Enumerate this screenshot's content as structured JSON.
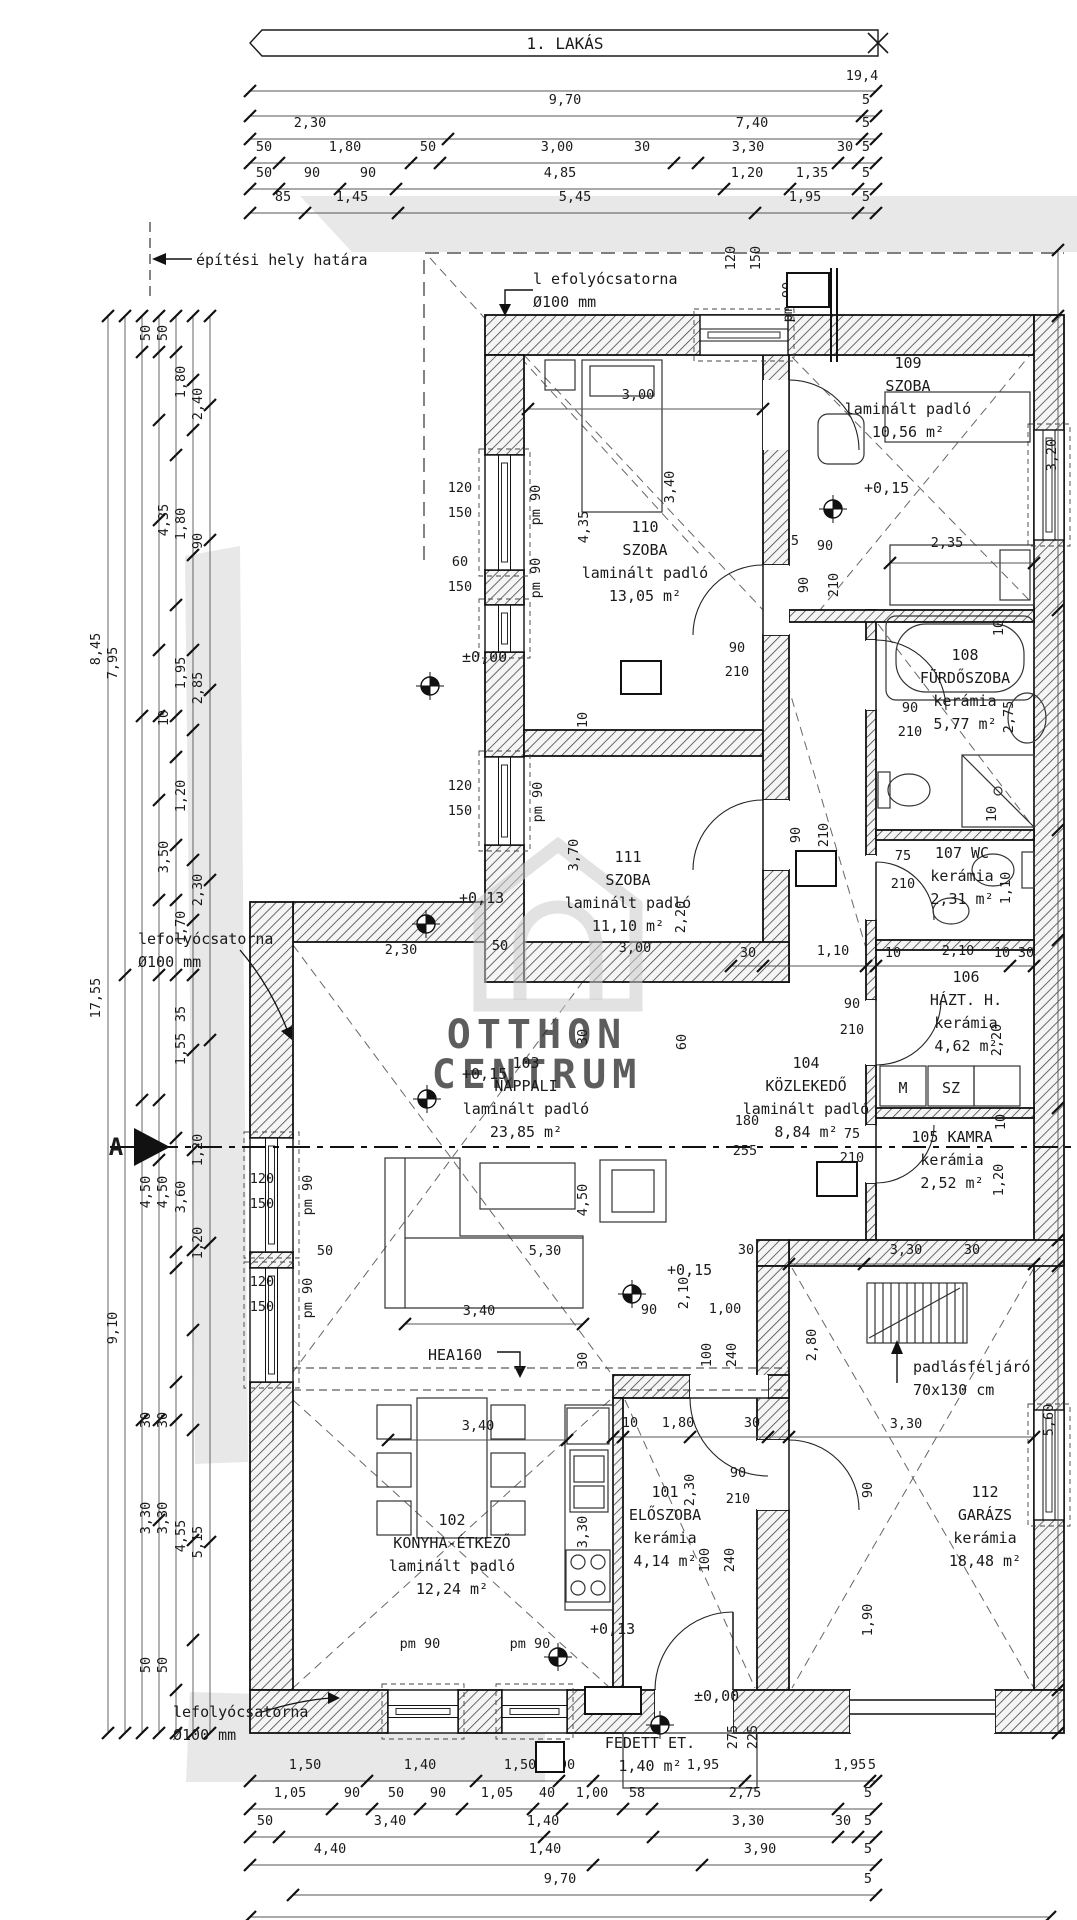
{
  "title": {
    "banner": "1. LAKÁS"
  },
  "watermark": {
    "line1": "OTTHON",
    "line2": "CENTRUM"
  },
  "section_marker": {
    "label": "A"
  },
  "colors": {
    "paper": "#ffffff",
    "site_band": "#e8e8e8",
    "ink": "#1a1a1a",
    "watermark_grey": "#c6c6c6"
  },
  "rooms": [
    {
      "id": "110",
      "lines": [
        "110",
        "SZOBA",
        "laminált padló",
        "13,05 m²"
      ],
      "x": 645,
      "y": 532
    },
    {
      "id": "109",
      "lines": [
        "109",
        "SZOBA",
        "laminált padló",
        "10,56 m²"
      ],
      "x": 908,
      "y": 368
    },
    {
      "id": "108",
      "lines": [
        "108",
        "FÜRDŐSZOBA",
        "kerámia",
        "5,77 m²"
      ],
      "x": 965,
      "y": 660
    },
    {
      "id": "107",
      "lines": [
        "107 WC",
        "kerámia",
        "2,31 m²"
      ],
      "x": 962,
      "y": 858
    },
    {
      "id": "106",
      "lines": [
        "106",
        "HÁZT. H.",
        "kerámia",
        "4,62 m²"
      ],
      "x": 966,
      "y": 982
    },
    {
      "id": "105",
      "lines": [
        "105 KAMRA",
        "kerámia",
        "2,52 m²"
      ],
      "x": 952,
      "y": 1142
    },
    {
      "id": "104",
      "lines": [
        "104",
        "KÖZLEKEDŐ",
        "laminált padló",
        "8,84 m²"
      ],
      "x": 806,
      "y": 1068
    },
    {
      "id": "103",
      "lines": [
        "103",
        "NAPPALI",
        "laminált padló",
        "23,85 m²"
      ],
      "x": 526,
      "y": 1068
    },
    {
      "id": "111",
      "lines": [
        "111",
        "SZOBA",
        "laminált padló",
        "11,10 m²"
      ],
      "x": 628,
      "y": 862
    },
    {
      "id": "102",
      "lines": [
        "102",
        "KONYHA-ÉTKEZŐ",
        "laminált padló",
        "12,24 m²"
      ],
      "x": 452,
      "y": 1525
    },
    {
      "id": "101",
      "lines": [
        "101",
        "ELŐSZOBA",
        "kerámia",
        "4,14 m²"
      ],
      "x": 665,
      "y": 1497
    },
    {
      "id": "112",
      "lines": [
        "112",
        "GARÁZS",
        "kerámia",
        "18,48 m²"
      ],
      "x": 985,
      "y": 1497
    },
    {
      "id": "K101",
      "lines": [
        "FEDETT ET.",
        "1,40 m²"
      ],
      "x": 650,
      "y": 1748
    }
  ],
  "ref_boxes": [
    {
      "t": "H01",
      "x": 787,
      "y": 273,
      "w": 42,
      "h": 34
    },
    {
      "t": "F04",
      "x": 621,
      "y": 661,
      "w": 40,
      "h": 33
    },
    {
      "t": "F01",
      "x": 796,
      "y": 851,
      "w": 40,
      "h": 35
    },
    {
      "t": "F02",
      "x": 817,
      "y": 1162,
      "w": 40,
      "h": 34
    },
    {
      "t": "K101",
      "x": 585,
      "y": 1687,
      "w": 56,
      "h": 27
    },
    {
      "t": "1",
      "x": 536,
      "y": 1742,
      "w": 28,
      "h": 30
    }
  ],
  "level_markers": [
    {
      "t": "±0,00",
      "tx": 458,
      "ty": 662,
      "mx": 430,
      "my": 686
    },
    {
      "t": "+0,13",
      "tx": 455,
      "ty": 903,
      "mx": 426,
      "my": 924
    },
    {
      "t": "+0,15",
      "tx": 860,
      "ty": 493,
      "mx": 833,
      "my": 509
    },
    {
      "t": "+0,15",
      "tx": 458,
      "ty": 1079,
      "mx": 427,
      "my": 1099
    },
    {
      "t": "+0,15",
      "tx": 663,
      "ty": 1275,
      "mx": 632,
      "my": 1294
    },
    {
      "t": "+0,13",
      "tx": 586,
      "ty": 1634,
      "mx": 558,
      "my": 1657
    },
    {
      "t": "±0,00",
      "tx": 690,
      "ty": 1701,
      "mx": 660,
      "my": 1725
    }
  ],
  "notes": [
    {
      "t": "l efolyócsatorna",
      "x": 533,
      "y": 284
    },
    {
      "t": "Ø100 mm",
      "x": 533,
      "y": 307
    },
    {
      "t": "építési hely határa",
      "x": 196,
      "y": 265
    },
    {
      "t": "lefolyócsatorna",
      "x": 138,
      "y": 944
    },
    {
      "t": "Ø100 mm",
      "x": 138,
      "y": 967
    },
    {
      "t": "lefolyócsatorna",
      "x": 173,
      "y": 1717
    },
    {
      "t": "Ø100 mm",
      "x": 173,
      "y": 1740
    },
    {
      "t": "padlásfeljáró",
      "x": 913,
      "y": 1372
    },
    {
      "t": "70x130 cm",
      "x": 913,
      "y": 1395
    },
    {
      "t": "HEA160",
      "x": 428,
      "y": 1360
    }
  ],
  "appliances": [
    {
      "t": "M",
      "x": 903,
      "y": 1093
    },
    {
      "t": "SZ",
      "x": 951,
      "y": 1093
    }
  ],
  "dimensions": [
    [
      "19,4",
      862,
      80,
      0
    ],
    [
      "9,70",
      565,
      104,
      0
    ],
    [
      "5",
      866,
      104,
      0
    ],
    [
      "2,30",
      310,
      127,
      0
    ],
    [
      "7,40",
      752,
      127,
      0
    ],
    [
      "5",
      866,
      127,
      0
    ],
    [
      "50",
      264,
      151,
      0
    ],
    [
      "1,80",
      345,
      151,
      0
    ],
    [
      "50",
      428,
      151,
      0
    ],
    [
      "3,00",
      557,
      151,
      0
    ],
    [
      "30",
      642,
      151,
      0
    ],
    [
      "3,30",
      748,
      151,
      0
    ],
    [
      "30",
      845,
      151,
      0
    ],
    [
      "5",
      866,
      151,
      0
    ],
    [
      "50",
      264,
      177,
      0
    ],
    [
      "90",
      312,
      177,
      0
    ],
    [
      "90",
      368,
      177,
      0
    ],
    [
      "4,85",
      560,
      177,
      0
    ],
    [
      "1,20",
      747,
      177,
      0
    ],
    [
      "1,35",
      812,
      177,
      0
    ],
    [
      "5",
      866,
      177,
      0
    ],
    [
      "85",
      283,
      201,
      0
    ],
    [
      "1,45",
      352,
      201,
      0
    ],
    [
      "5,45",
      575,
      201,
      0
    ],
    [
      "1,95",
      805,
      201,
      0
    ],
    [
      "5",
      866,
      201,
      0
    ],
    [
      "50",
      150,
      333,
      1
    ],
    [
      "50",
      167,
      333,
      1
    ],
    [
      "1,80",
      185,
      382,
      1
    ],
    [
      "2,40",
      202,
      404,
      1
    ],
    [
      "4,35",
      168,
      520,
      1
    ],
    [
      "1,80",
      185,
      524,
      1
    ],
    [
      "90",
      202,
      541,
      1
    ],
    [
      "8,45",
      100,
      649,
      1
    ],
    [
      "7,95",
      117,
      663,
      1
    ],
    [
      "1,95",
      185,
      673,
      1
    ],
    [
      "2,85",
      202,
      688,
      1
    ],
    [
      "10",
      168,
      718,
      1
    ],
    [
      "1,20",
      185,
      796,
      1
    ],
    [
      "3,50",
      168,
      857,
      1
    ],
    [
      "2,30",
      202,
      890,
      1
    ],
    [
      "1,70",
      185,
      927,
      1
    ],
    [
      "17,55",
      100,
      998,
      1
    ],
    [
      "35",
      185,
      1014,
      1
    ],
    [
      "1,55",
      185,
      1049,
      1
    ],
    [
      "1,20",
      202,
      1150,
      1
    ],
    [
      "4,50",
      150,
      1192,
      1
    ],
    [
      "4,50",
      167,
      1192,
      1
    ],
    [
      "3,60",
      185,
      1197,
      1
    ],
    [
      "1,20",
      202,
      1243,
      1
    ],
    [
      "9,10",
      117,
      1328,
      1
    ],
    [
      "30",
      150,
      1420,
      1
    ],
    [
      "30",
      167,
      1420,
      1
    ],
    [
      "3,30",
      150,
      1518,
      1
    ],
    [
      "3,30",
      167,
      1518,
      1
    ],
    [
      "4,55",
      185,
      1536,
      1
    ],
    [
      "5,15",
      202,
      1542,
      1
    ],
    [
      "50",
      150,
      1665,
      1
    ],
    [
      "50",
      167,
      1665,
      1
    ],
    [
      "1,50",
      305,
      1769,
      0
    ],
    [
      "1,40",
      420,
      1769,
      0
    ],
    [
      "1,50",
      520,
      1769,
      0
    ],
    [
      "90",
      567,
      1769,
      0
    ],
    [
      "1,95",
      703,
      1769,
      0
    ],
    [
      "1,95",
      850,
      1769,
      0
    ],
    [
      "5",
      872,
      1769,
      0
    ],
    [
      "1,05",
      290,
      1797,
      0
    ],
    [
      "90",
      352,
      1797,
      0
    ],
    [
      "50",
      396,
      1797,
      0
    ],
    [
      "90",
      438,
      1797,
      0
    ],
    [
      "1,05",
      497,
      1797,
      0
    ],
    [
      "40",
      547,
      1797,
      0
    ],
    [
      "1,00",
      592,
      1797,
      0
    ],
    [
      "58",
      637,
      1797,
      0
    ],
    [
      "2,75",
      745,
      1797,
      0
    ],
    [
      "5",
      868,
      1797,
      0
    ],
    [
      "50",
      265,
      1825,
      0
    ],
    [
      "3,40",
      390,
      1825,
      0
    ],
    [
      "1,40",
      543,
      1825,
      0
    ],
    [
      "3,30",
      748,
      1825,
      0
    ],
    [
      "30",
      843,
      1825,
      0
    ],
    [
      "5",
      868,
      1825,
      0
    ],
    [
      "4,40",
      330,
      1853,
      0
    ],
    [
      "1,40",
      545,
      1853,
      0
    ],
    [
      "3,90",
      760,
      1853,
      0
    ],
    [
      "5",
      868,
      1853,
      0
    ],
    [
      "9,70",
      560,
      1883,
      0
    ],
    [
      "5",
      868,
      1883,
      0
    ],
    [
      "275",
      737,
      1737,
      1
    ],
    [
      "225",
      757,
      1737,
      1
    ],
    [
      "3,20",
      1056,
      455,
      1
    ],
    [
      "10",
      1003,
      628,
      1
    ],
    [
      "2,75",
      1013,
      717,
      1
    ],
    [
      "10",
      996,
      814,
      1
    ],
    [
      "1,10",
      1010,
      888,
      1
    ],
    [
      "2,20",
      1001,
      1040,
      1
    ],
    [
      "10",
      1005,
      1122,
      1
    ],
    [
      "1,20",
      1003,
      1180,
      1
    ],
    [
      "5,60",
      1053,
      1420,
      1
    ],
    [
      "90",
      872,
      1490,
      1
    ],
    [
      "1,90",
      872,
      1620,
      1
    ],
    [
      "2,80",
      816,
      1345,
      1
    ],
    [
      "3,00",
      638,
      399,
      0
    ],
    [
      "4,35",
      588,
      527,
      1
    ],
    [
      "3,40",
      674,
      487,
      1
    ],
    [
      "2,35",
      947,
      547,
      0
    ],
    [
      "5",
      795,
      545,
      0
    ],
    [
      "90",
      825,
      550,
      0
    ],
    [
      "90",
      808,
      585,
      1
    ],
    [
      "210",
      838,
      585,
      1
    ],
    [
      "90",
      737,
      652,
      0
    ],
    [
      "210",
      737,
      676,
      0
    ],
    [
      "90",
      910,
      712,
      0
    ],
    [
      "210",
      910,
      736,
      0
    ],
    [
      "75",
      903,
      860,
      0
    ],
    [
      "210",
      903,
      888,
      0
    ],
    [
      "90",
      852,
      1008,
      0
    ],
    [
      "210",
      852,
      1034,
      0
    ],
    [
      "75",
      852,
      1138,
      0
    ],
    [
      "210",
      852,
      1162,
      0
    ],
    [
      "90",
      800,
      835,
      1
    ],
    [
      "210",
      828,
      835,
      1
    ],
    [
      "3,70",
      578,
      855,
      1
    ],
    [
      "2,20",
      685,
      917,
      1
    ],
    [
      "3,00",
      635,
      952,
      0
    ],
    [
      "2,30",
      401,
      954,
      0
    ],
    [
      "50",
      500,
      950,
      0
    ],
    [
      "30",
      748,
      957,
      0
    ],
    [
      "1,10",
      833,
      955,
      0
    ],
    [
      "10",
      893,
      957,
      0
    ],
    [
      "2,10",
      958,
      955,
      0
    ],
    [
      "10",
      1002,
      957,
      0
    ],
    [
      "30",
      1026,
      957,
      0
    ],
    [
      "180",
      747,
      1125,
      0
    ],
    [
      "255",
      745,
      1155,
      0
    ],
    [
      "60",
      686,
      1042,
      1
    ],
    [
      "30",
      587,
      1037,
      1
    ],
    [
      "10",
      587,
      720,
      1
    ],
    [
      "5,30",
      545,
      1255,
      0
    ],
    [
      "3,40",
      479,
      1315,
      0
    ],
    [
      "4,50",
      587,
      1200,
      1
    ],
    [
      "2,10",
      688,
      1293,
      1
    ],
    [
      "90",
      649,
      1314,
      0
    ],
    [
      "1,00",
      725,
      1313,
      0
    ],
    [
      "100",
      711,
      1355,
      1
    ],
    [
      "240",
      736,
      1355,
      1
    ],
    [
      "30",
      587,
      1360,
      1
    ],
    [
      "10",
      630,
      1427,
      0
    ],
    [
      "1,80",
      678,
      1427,
      0
    ],
    [
      "30",
      752,
      1427,
      0
    ],
    [
      "3,30",
      906,
      1254,
      0
    ],
    [
      "30",
      746,
      1254,
      0
    ],
    [
      "30",
      972,
      1254,
      0
    ],
    [
      "3,30",
      906,
      1428,
      0
    ],
    [
      "2,30",
      694,
      1490,
      1
    ],
    [
      "90",
      738,
      1477,
      0
    ],
    [
      "210",
      738,
      1503,
      0
    ],
    [
      "100",
      709,
      1560,
      1
    ],
    [
      "240",
      734,
      1560,
      1
    ],
    [
      "3,30",
      587,
      1532,
      1
    ],
    [
      "3,40",
      478,
      1430,
      0
    ],
    [
      "120",
      460,
      492,
      0
    ],
    [
      "150",
      460,
      517,
      0
    ],
    [
      "60",
      460,
      566,
      0
    ],
    [
      "150",
      460,
      591,
      0
    ],
    [
      "120",
      460,
      790,
      0
    ],
    [
      "150",
      460,
      815,
      0
    ],
    [
      "120",
      735,
      258,
      1
    ],
    [
      "150",
      760,
      258,
      1
    ],
    [
      "120",
      262,
      1183,
      0
    ],
    [
      "150",
      262,
      1208,
      0
    ],
    [
      "120",
      262,
      1286,
      0
    ],
    [
      "150",
      262,
      1311,
      0
    ],
    [
      "50",
      325,
      1255,
      0
    ],
    [
      "pm 90",
      540,
      505,
      1
    ],
    [
      "pm 90",
      540,
      578,
      1
    ],
    [
      "pm 90",
      542,
      802,
      1
    ],
    [
      "pm 90",
      792,
      302,
      1
    ],
    [
      "pm 90",
      312,
      1195,
      1
    ],
    [
      "pm 90",
      312,
      1298,
      1
    ],
    [
      "pm 90",
      420,
      1648,
      0
    ],
    [
      "pm 90",
      530,
      1648,
      0
    ]
  ]
}
